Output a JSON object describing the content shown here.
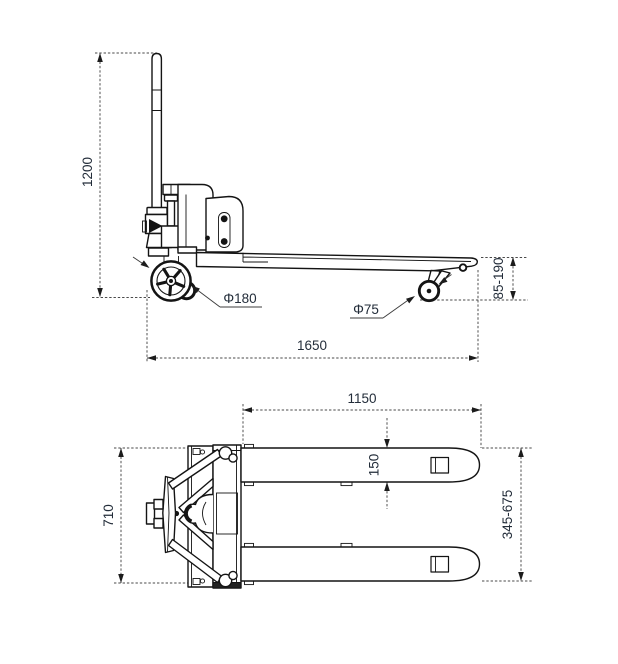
{
  "drawing": {
    "side_view": {
      "dims": {
        "overall_height": "1200",
        "overall_length": "1650",
        "fork_height_range": "85-190",
        "steer_wheel_diameter": "Φ180",
        "load_roller_diameter": "Φ75"
      }
    },
    "top_view": {
      "dims": {
        "fork_length": "1150",
        "fork_width": "150",
        "overall_width": "710",
        "fork_span_range": "345-675"
      }
    }
  }
}
